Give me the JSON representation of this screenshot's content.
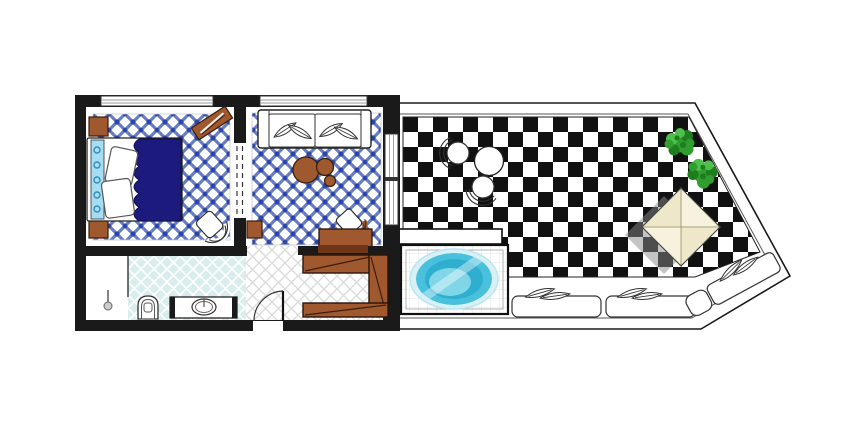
{
  "meta": {
    "kind": "hotel-suite-floor-plan",
    "orientation": "top-down"
  },
  "colors": {
    "white": "#ffffff",
    "wall": "#1a1a1a",
    "outline": "#2a2a2a",
    "tile_blue": "#4d66bb",
    "tile_blue_dark": "#2e47a3",
    "bed_navy": "#1d1a7e",
    "bed_navy_edge": "#10104a",
    "headboard_blue": "#a8dcf0",
    "headboard_swirl": "#2e8fc0",
    "wood": "#a0592f",
    "wood_dark": "#6e3517",
    "wood_line": "#3a1d0e",
    "bath_floor": "#d8eded",
    "grid_gray": "#d9d9d9",
    "pool_tile_line": "#e3e3e3",
    "checker_dark": "#111111",
    "pool_rim": "#d8f1f7",
    "pool_mid": "#49c0dc",
    "pool_deep": "#2fafcf",
    "pool_light": "#7fd6e7",
    "plant_dark": "#1e7d1e",
    "plant_mid": "#2f9e2f",
    "plant_light": "#4cbf4c",
    "canopy": "#f7f2dd",
    "canopy_shade": "#eee7c9",
    "shadow": "#8a8a8a"
  },
  "rooms": {
    "bedroom": {
      "label": "bedroom",
      "items": [
        "double-bed",
        "headboard",
        "pillows",
        "nightstand-top",
        "nightstand-bottom",
        "wall-shelf",
        "armchair"
      ]
    },
    "living": {
      "label": "living-room",
      "items": [
        "sofa",
        "seat-cushions",
        "coffee-table-large",
        "coffee-table-medium",
        "coffee-table-small",
        "side-chair",
        "console-desk",
        "cabinet"
      ]
    },
    "bathroom": {
      "label": "bathroom",
      "items": [
        "shower",
        "shower-head",
        "toilet",
        "vanity-sink"
      ]
    },
    "hallway": {
      "label": "entrance-hall",
      "items": [
        "entry-door"
      ]
    },
    "closet": {
      "label": "dressing-area",
      "items": [
        "wardrobe"
      ]
    },
    "terrace": {
      "label": "terrace",
      "items": [
        "checkerboard-floor",
        "plunge-pool",
        "pool-deck",
        "bistro-table",
        "bistro-chair-left",
        "bistro-chair-front",
        "plant-1",
        "plant-2",
        "canopy-daybed",
        "daybed-shadow",
        "sun-lounger-1",
        "sun-lounger-2",
        "sun-lounger-diagonal",
        "lounger-cushions"
      ]
    }
  }
}
